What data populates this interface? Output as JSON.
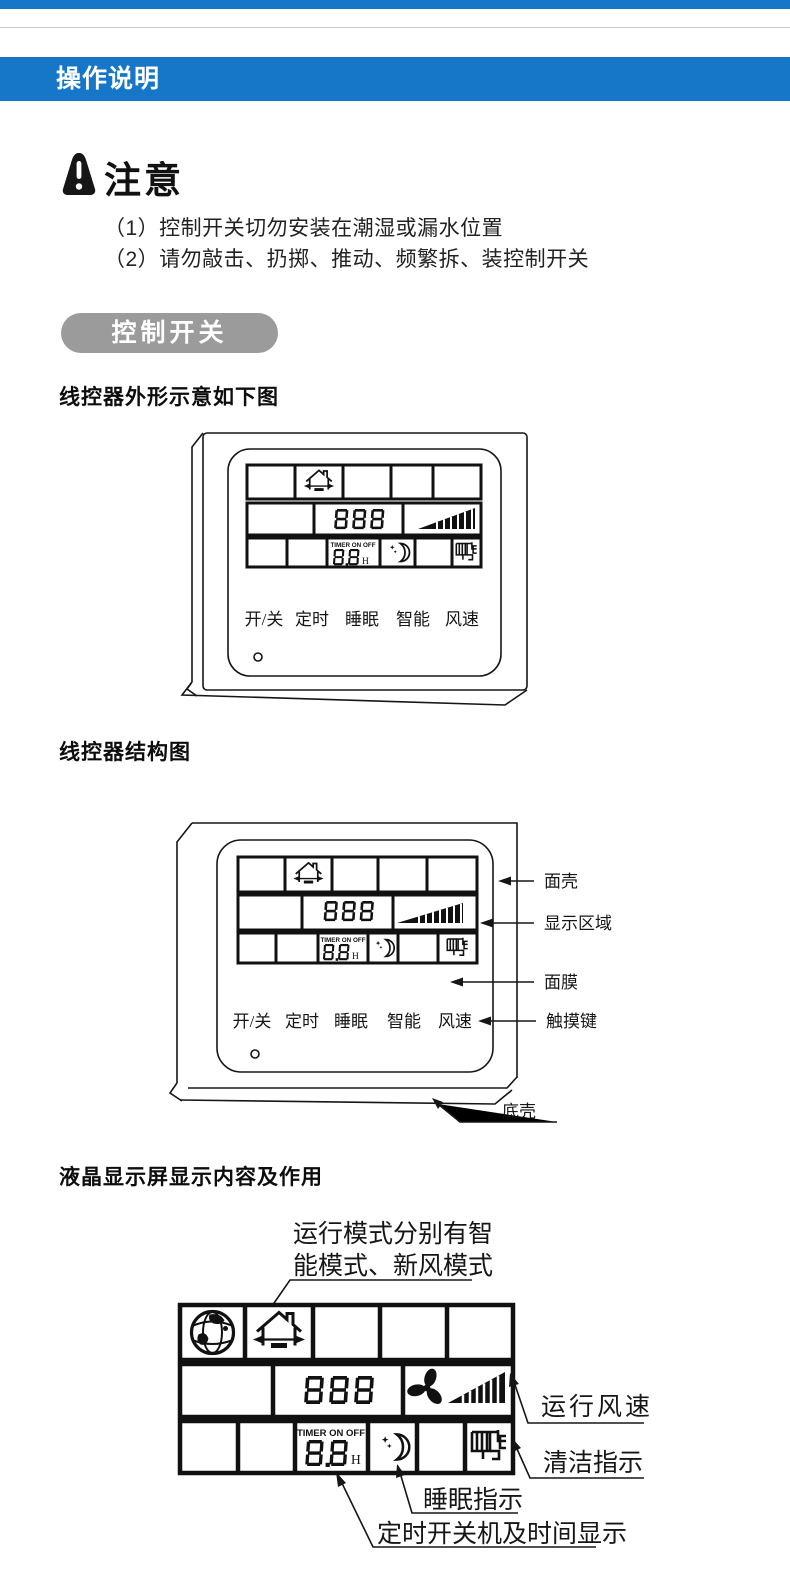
{
  "page": {
    "header": {
      "title": "操作说明"
    },
    "notice": {
      "title": "注意",
      "item1": "（1）控制开关切勿安装在潮湿或漏水位置",
      "item2": "（2）请勿敲击、扔掷、推动、频繁拆、装控制开关"
    },
    "pill_label": "控制开关",
    "headings": {
      "outline": "线控器外形示意如下图",
      "structure": "线控器结构图",
      "lcd": "液晶显示屏显示内容及作用"
    }
  },
  "lcd": {
    "digits": "888",
    "timer_label": "TIMER ON OFF",
    "timer_value": "8.8",
    "timer_unit": "H"
  },
  "buttons": {
    "power": "开/关",
    "timer": "定时",
    "sleep": "睡眠",
    "smart": "智能",
    "fan": "风速"
  },
  "structure_labels": {
    "face_shell": "面壳",
    "display_area": "显示区域",
    "membrane": "面膜",
    "touch_keys": "触摸键",
    "bottom_shell": "底壳"
  },
  "lcd_annotations": {
    "mode_line1": "运行模式分别有智",
    "mode_line2": "能模式、新风模式",
    "fan_speed": "运行风速",
    "clean": "清洁指示",
    "sleep": "睡眠指示",
    "timer": "定时开关机及时间显示"
  },
  "colors": {
    "accent_blue": "#1677c8",
    "pill_gray": "#9b9b9b"
  }
}
